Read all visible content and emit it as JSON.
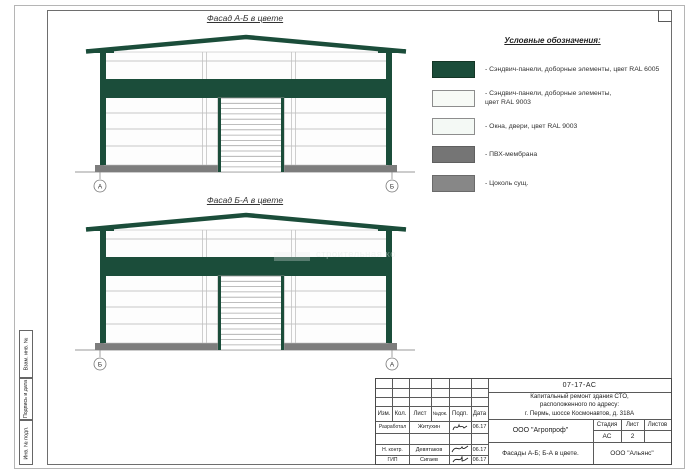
{
  "facade1": {
    "title": "Фасад А-Б в цвете",
    "axis_left": "А",
    "axis_right": "Б"
  },
  "facade2": {
    "title": "Фасад Б-А в цвете",
    "axis_left": "Б",
    "axis_right": "А"
  },
  "legend": {
    "title": "Условные обозначения:",
    "items": [
      {
        "label": "- Сэндвич-панели, доборные элементы,  цвет RAL 6005",
        "color": "#1b4d3a"
      },
      {
        "label": "- Сэндвич-панели, доборные элементы,\nцвет RAL 9003",
        "color": "#f7faf6"
      },
      {
        "label": "- Окна, двери, цвет RAL 9003",
        "color": "#f4f9f5"
      },
      {
        "label": "- ПВХ-мембрана",
        "color": "#757575"
      },
      {
        "label": "- Цоколь сущ.",
        "color": "#878787"
      }
    ]
  },
  "margin_labels": [
    "Взам. инв. №",
    "Подпись и дата",
    "Инв. № подл."
  ],
  "title_block": {
    "doc_number": "07-17-АС",
    "project": "Капитальный ремонт здания СТО,\nрасположенного по адресу:\nг. Пермь, шоссе Космонавтов, д. 318А",
    "header": {
      "izm": "Изм.",
      "kol": "Кол.",
      "list": "Лист",
      "ndok": "№док.",
      "podp": "Подп.",
      "data": "Дата"
    },
    "rows": [
      {
        "role": "Разработал",
        "name": "Житухин",
        "date": "06.17"
      },
      {
        "role": "",
        "name": "",
        "date": ""
      },
      {
        "role": "Н. контр.",
        "name": "Девятаков",
        "date": "06.17"
      },
      {
        "role": "ГИП",
        "name": "Сигаев",
        "date": "06.17"
      }
    ],
    "company": "ООО \"Агропроф\"",
    "stage_header": {
      "stage": "Стадия",
      "sheet": "Лист",
      "sheets": "Листов"
    },
    "stage": "АС",
    "sheet_no": "2",
    "sheets_total": "",
    "drawing_title": "Фасады А-Б; Б-А в цвете.",
    "contractor": "ООО \"Альянс\""
  },
  "watermark": "строительная ко",
  "colors": {
    "ral6005": "#1b4d3a",
    "ral9003": "#f7faf6",
    "pvc_membrane": "#757575",
    "plinth": "#7d7d7d"
  }
}
